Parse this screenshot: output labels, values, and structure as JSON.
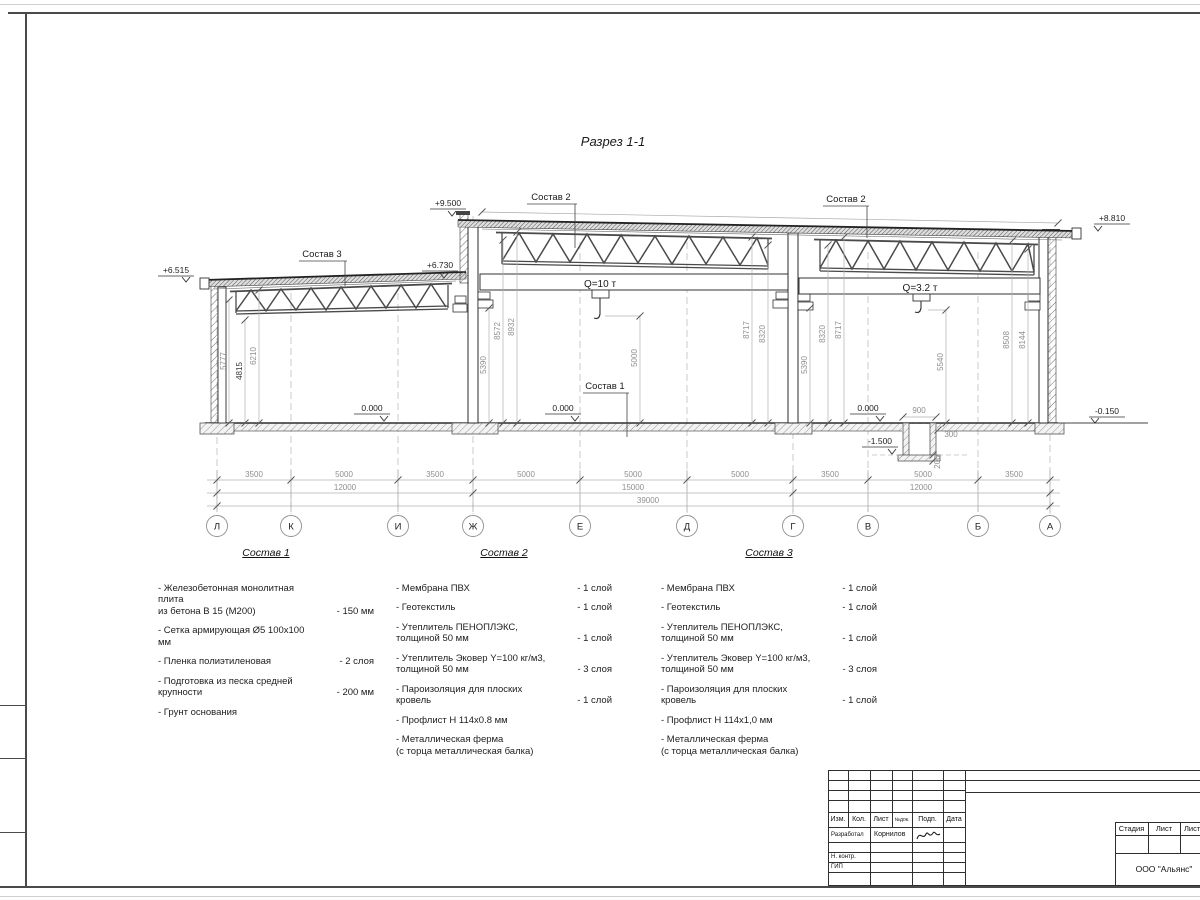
{
  "page": {
    "title": "Разрез 1-1"
  },
  "section": {
    "elev": {
      "e6515": "+6.515",
      "e9500": "+9.500",
      "e6730": "+6.730",
      "e8810": "+8.810",
      "zero1": "0.000",
      "zero2": "0.000",
      "zero3": "0.000",
      "pit": "-1.500",
      "ground": "-0.150"
    },
    "cranes": {
      "mid": "Q=10 т",
      "right": "Q=3.2 т"
    },
    "leaders": {
      "s1": "Состав 1",
      "s2": "Состав 2",
      "s3": "Состав 3"
    },
    "vdims": {
      "lb1": "5777",
      "lb2": "4815",
      "lb3": "6210",
      "mb1": "5390",
      "mb2": "8572",
      "mb3": "8932",
      "mbc": "5000",
      "mb4": "8717",
      "mb5": "8320",
      "rb1": "5390",
      "rb2": "8320",
      "rb3": "8717",
      "rbc": "5540",
      "rb4": "8508",
      "rb5": "8144"
    },
    "pitdims": {
      "w": "900",
      "a": "300",
      "b": "200"
    },
    "hrow1": [
      "3500",
      "5000",
      "3500",
      "5000",
      "5000",
      "5000",
      "3500",
      "5000",
      "3500"
    ],
    "hrow2": [
      "12000",
      "15000",
      "12000"
    ],
    "total": "39000",
    "grid": [
      "Л",
      "К",
      "И",
      "Ж",
      "Е",
      "Д",
      "Г",
      "В",
      "Б",
      "А"
    ]
  },
  "compositions": [
    {
      "title": "Состав 1",
      "items": [
        {
          "lines": [
            "- Железобетонная  монолитная плита",
            "из бетона В 15 (М200)"
          ],
          "value": "- 150 мм"
        },
        {
          "lines": [
            "- Сетка армирующая Ø5 100х100 мм"
          ],
          "value": ""
        },
        {
          "lines": [
            "- Пленка полиэтиленовая"
          ],
          "value": "-  2 слоя"
        },
        {
          "lines": [
            "- Подготовка из песка средней",
            "крупности"
          ],
          "value": "- 200 мм"
        },
        {
          "lines": [
            "- Грунт основания"
          ],
          "value": ""
        }
      ]
    },
    {
      "title": "Состав 2",
      "items": [
        {
          "lines": [
            "- Мембрана ПВХ"
          ],
          "value": "- 1 слой"
        },
        {
          "lines": [
            "- Геотекстиль"
          ],
          "value": "- 1 слой"
        },
        {
          "lines": [
            "- Утеплитель ПЕНОПЛЭКС,",
            "толщиной 50 мм"
          ],
          "value": "- 1 слой"
        },
        {
          "lines": [
            "- Утеплитель Эковер Y=100 кг/м3,",
            "толщиной 50 мм"
          ],
          "value": "- 3 слоя"
        },
        {
          "lines": [
            "- Пароизоляция для плоских кровель"
          ],
          "value": "- 1 слой"
        },
        {
          "lines": [
            "- Профлист Н 114х0.8 мм"
          ],
          "value": ""
        },
        {
          "lines": [
            "- Металлическая ферма",
            "(с торца металлическая балка)"
          ],
          "value": ""
        }
      ]
    },
    {
      "title": "Состав 3",
      "items": [
        {
          "lines": [
            "- Мембрана ПВХ"
          ],
          "value": "- 1 слой"
        },
        {
          "lines": [
            "- Геотекстиль"
          ],
          "value": "- 1 слой"
        },
        {
          "lines": [
            "- Утеплитель ПЕНОПЛЭКС,",
            "толщиной 50 мм"
          ],
          "value": "- 1 слой"
        },
        {
          "lines": [
            "- Утеплитель Эковер Y=100 кг/м3,",
            "толщиной 50 мм"
          ],
          "value": "- 3 слоя"
        },
        {
          "lines": [
            "- Пароизоляция для плоских кровель"
          ],
          "value": "- 1 слой"
        },
        {
          "lines": [
            "- Профлист Н 114х1,0 мм"
          ],
          "value": ""
        },
        {
          "lines": [
            "- Металлическая ферма",
            "(с торца металлическая балка)"
          ],
          "value": ""
        }
      ]
    }
  ],
  "titleblock": {
    "headers": [
      "Изм.",
      "Кол.",
      "Лист",
      "№док.",
      "Подп.",
      "Дата"
    ],
    "developer_label": "Разработал",
    "developer_name": "Корнилов",
    "ncontr_label": "Н. контр.",
    "gip_label": "ГИП",
    "stage": [
      "Стадия",
      "Лист",
      "Листов"
    ],
    "company": "ООО \"Альянс\""
  }
}
